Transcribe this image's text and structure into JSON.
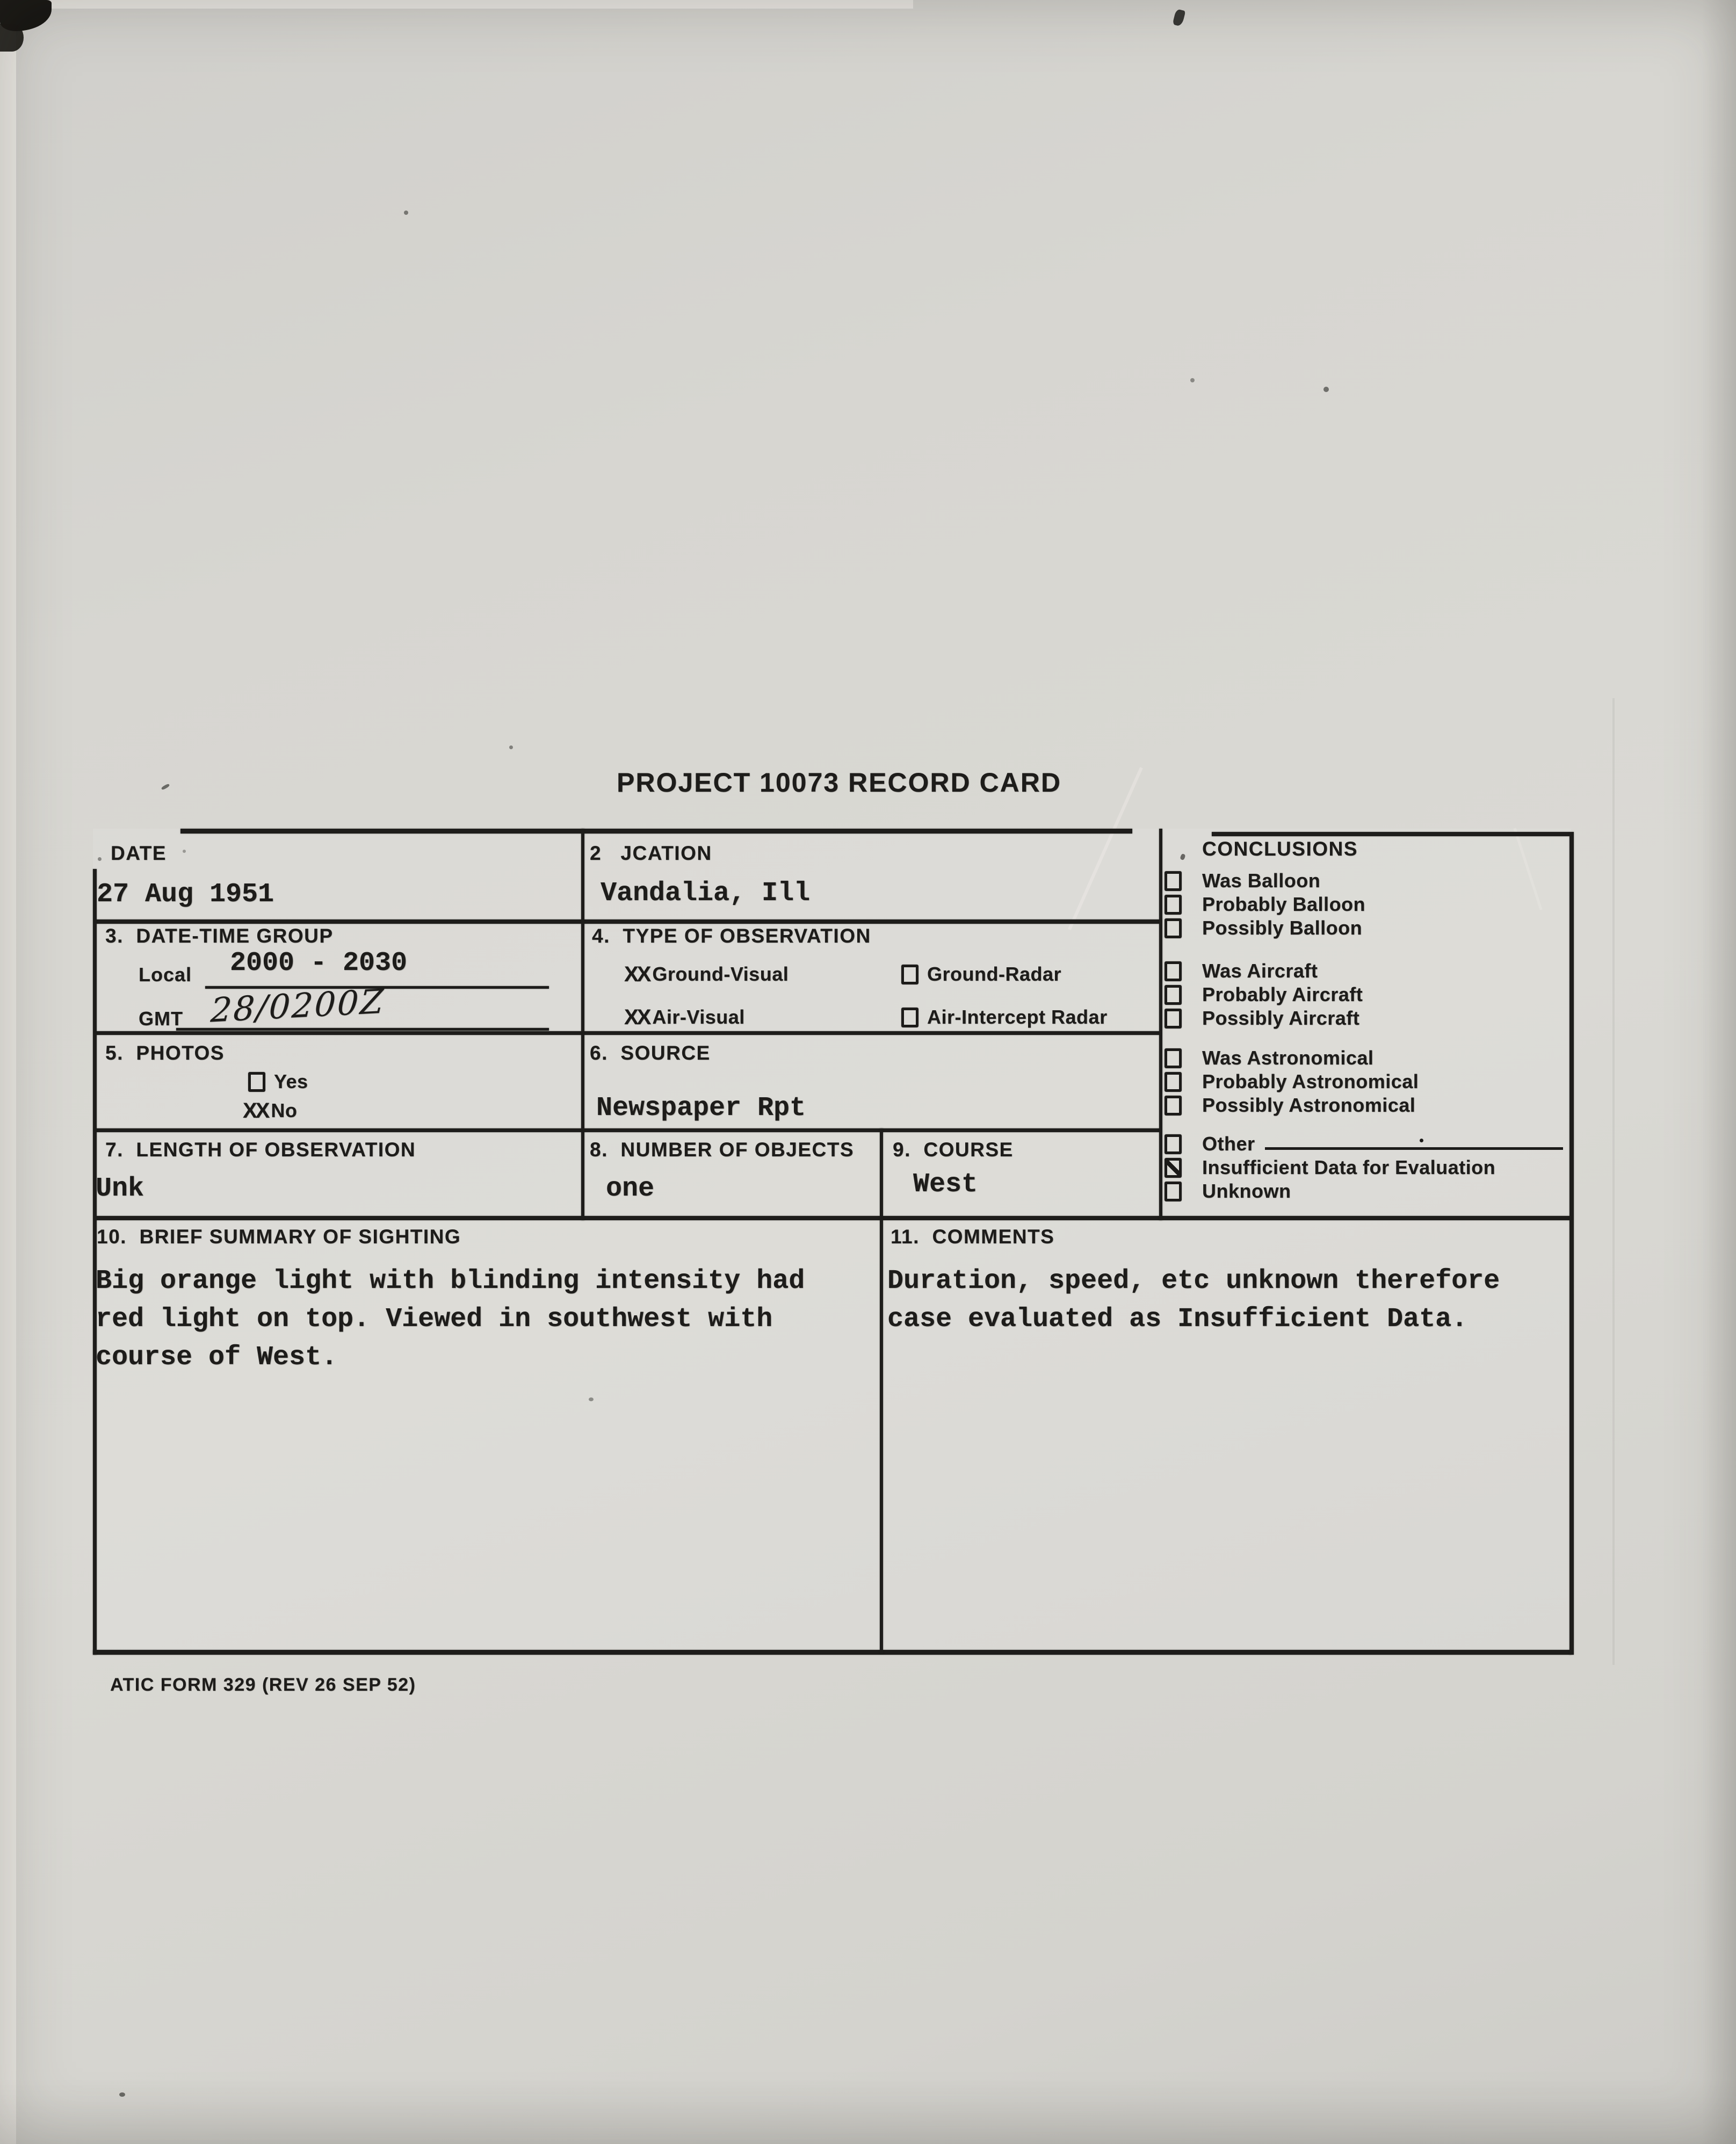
{
  "page": {
    "title": "PROJECT 10073 RECORD CARD",
    "footer": "ATIC FORM 329 (REV 26 SEP 52)",
    "ink_color": "#1d1c1a",
    "paper_color": "#d8d7d2"
  },
  "fields": {
    "date": {
      "label": "DATE",
      "value": "27 Aug 1951"
    },
    "location": {
      "label": "2   JCATION",
      "value": "Vandalia, Ill"
    },
    "date_time_group": {
      "label": "3.  DATE-TIME GROUP",
      "local_label": "Local",
      "local_value": "2000 - 2030",
      "gmt_label": "GMT",
      "gmt_value": "28/0200Z"
    },
    "type_of_observation": {
      "label": "4.  TYPE OF OBSERVATION",
      "options": [
        {
          "label": "Ground-Visual",
          "mark": "XX",
          "marked": true
        },
        {
          "label": "Ground-Radar",
          "mark": "",
          "marked": false
        },
        {
          "label": "Air-Visual",
          "mark": "XX",
          "marked": true
        },
        {
          "label": "Air-Intercept Radar",
          "mark": "",
          "marked": false
        }
      ]
    },
    "photos": {
      "label": "5.  PHOTOS",
      "options": [
        {
          "label": "Yes",
          "mark": "",
          "marked": false
        },
        {
          "label": "No",
          "mark": "XX",
          "marked": true
        }
      ]
    },
    "source": {
      "label": "6.  SOURCE",
      "value": "Newspaper Rpt"
    },
    "length_of_observation": {
      "label": "7.  LENGTH OF OBSERVATION",
      "value": "Unk"
    },
    "number_of_objects": {
      "label": "8.  NUMBER OF OBJECTS",
      "value": "one"
    },
    "course": {
      "label": "9.  COURSE",
      "value": "West"
    },
    "brief_summary": {
      "label": "10.  BRIEF SUMMARY OF SIGHTING",
      "text": "Big orange light with blinding intensity had\nred light on top. Viewed in southwest with\ncourse of West."
    },
    "comments": {
      "label": "11.  COMMENTS",
      "text": "Duration, speed, etc unknown therefore\ncase evaluated as Insufficient Data."
    }
  },
  "conclusions": {
    "label": "CONCLUSIONS",
    "groups": [
      {
        "items": [
          {
            "label": "Was Balloon",
            "checked": false
          },
          {
            "label": "Probably Balloon",
            "checked": false
          },
          {
            "label": "Possibly Balloon",
            "checked": false
          }
        ]
      },
      {
        "items": [
          {
            "label": "Was Aircraft",
            "checked": false
          },
          {
            "label": "Probably Aircraft",
            "checked": false
          },
          {
            "label": "Possibly Aircraft",
            "checked": false
          }
        ]
      },
      {
        "items": [
          {
            "label": "Was Astronomical",
            "checked": false
          },
          {
            "label": "Probably Astronomical",
            "checked": false
          },
          {
            "label": "Possibly Astronomical",
            "checked": false
          }
        ]
      },
      {
        "items": [
          {
            "label": "Other",
            "checked": false
          },
          {
            "label": "Insufficient Data for Evaluation",
            "checked": true
          },
          {
            "label": "Unknown",
            "checked": false
          }
        ]
      }
    ]
  }
}
